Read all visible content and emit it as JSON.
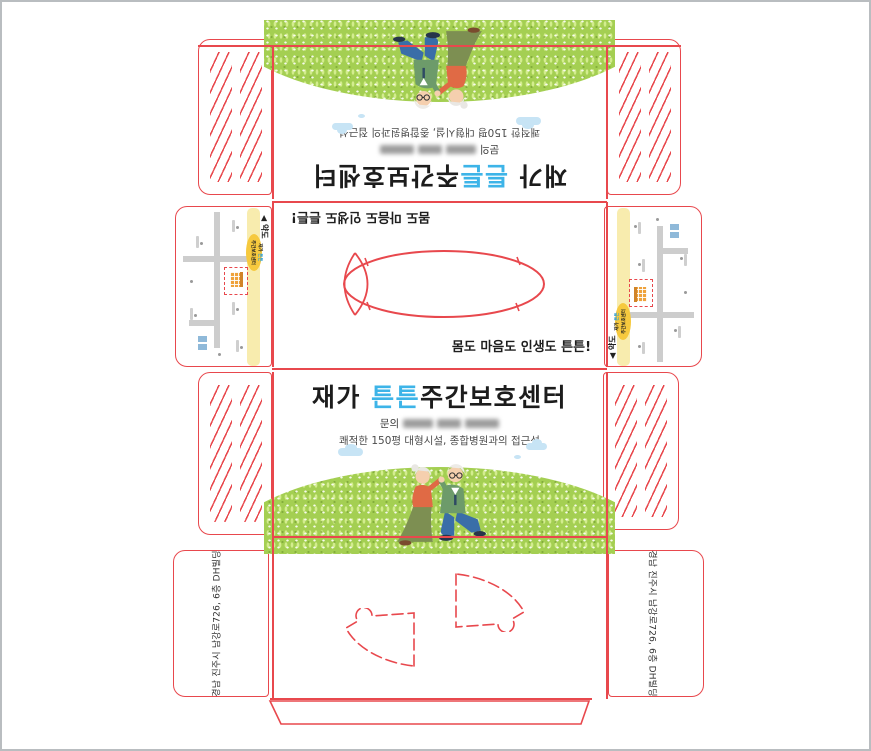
{
  "design": {
    "title_prefix": "재가 ",
    "title_highlight": "튼튼",
    "title_suffix": "주간보호센터",
    "contact_label": "문의",
    "subtitle": "쾌적한 150평 대형시설, 종합병원과의 접근성"
  },
  "middle_panel": {
    "slogan": "몸도 마음도 인생도 튼튼!"
  },
  "map_flap": {
    "label": "◀ 약도",
    "badge_prefix": "재가 ",
    "badge_highlight": "튼튼",
    "badge_line2": "주간보호센터"
  },
  "bottom_flaps": {
    "address": "경남 진주시 남강로726, 6층 DH빌딩"
  },
  "colors": {
    "die_line": "#e8484d",
    "highlight_blue": "#3db4e8",
    "grass_green": "#a4cf52",
    "cloud_blue": "#c7e4f5",
    "road_yellow": "#f8ecae",
    "badge_yellow": "#f6c93e"
  }
}
